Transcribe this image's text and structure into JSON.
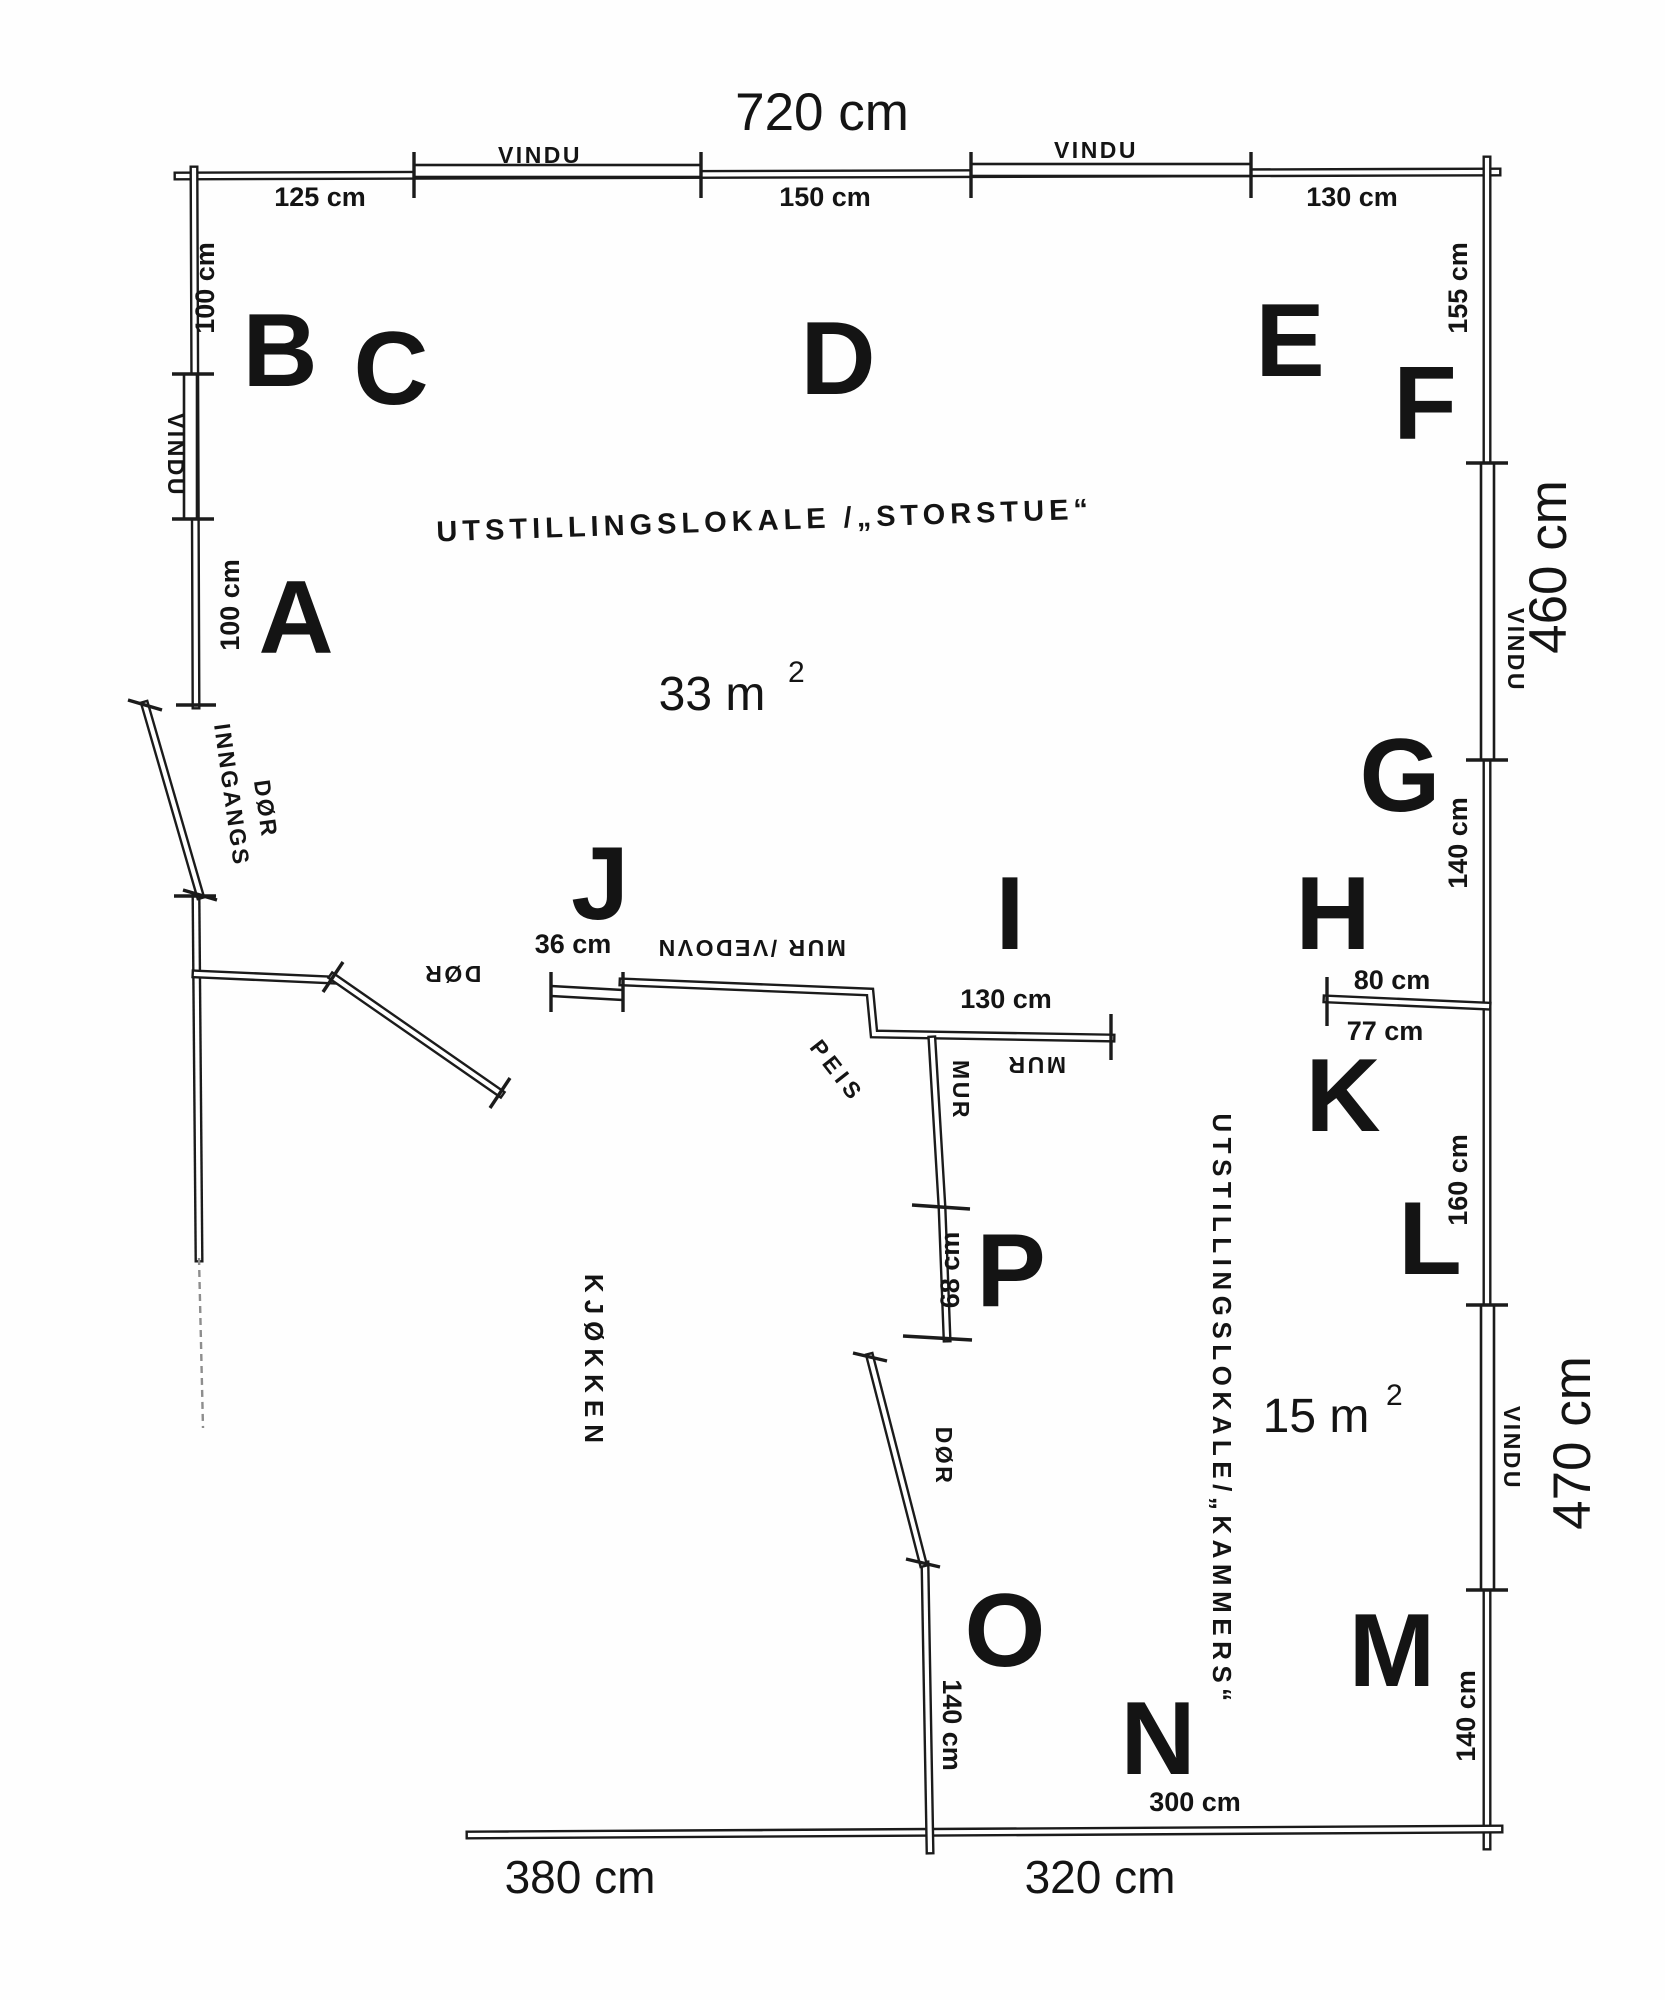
{
  "rooms": {
    "storstue": {
      "label": "UTSTILLINGSLOKALE /„STORSTUE“",
      "area": "33 m",
      "area_sup": "2"
    },
    "kammers": {
      "label": "UTSTILLINGSLOKALE/„KAMMERS“",
      "area": "15 m",
      "area_sup": "2"
    },
    "kjokken": {
      "label": "KJØKKEN"
    }
  },
  "letters": {
    "a": "A",
    "b": "B",
    "c": "C",
    "d": "D",
    "e": "E",
    "f": "F",
    "g": "G",
    "h": "H",
    "i": "I",
    "j": "J",
    "k": "K",
    "l": "L",
    "m": "M",
    "n": "N",
    "o": "O",
    "p": "P"
  },
  "overall_dims": {
    "top": "720 cm",
    "right_upper": "460 cm",
    "right_lower": "470 cm",
    "bottom_left": "380 cm",
    "bottom_right": "320 cm"
  },
  "wall_dims": {
    "top_left": "125 cm",
    "top_mid": "150 cm",
    "top_right": "130 cm",
    "left_upper": "100 cm",
    "left_lower": "100 cm",
    "right_f": "155 cm",
    "right_g": "140 cm",
    "right_k": "160 cm",
    "right_m": "140 cm",
    "vedovn_offset": "36 cm",
    "mur_mid": "130 cm",
    "mur_lower": "68 cm",
    "divider_80": "80 cm",
    "divider_77": "77 cm",
    "kammers_door_wall": "140 cm",
    "kammers_bottom": "300 cm"
  },
  "annotations": {
    "window_top_left": "VINDU",
    "window_top_right": "VINDU",
    "window_left": "VINDU",
    "window_right_upper": "VINDU",
    "window_right_lower": "VINDU",
    "entrance_line1": "INNGANGS",
    "entrance_line2": "DØR",
    "door_kitchen": "DØR",
    "door_kammers": "DØR",
    "mur_vedovn": "MUR /VEDOVN",
    "mur_horizontal": "MUR",
    "mur_vertical": "MUR",
    "fireplace": "PEIS"
  }
}
